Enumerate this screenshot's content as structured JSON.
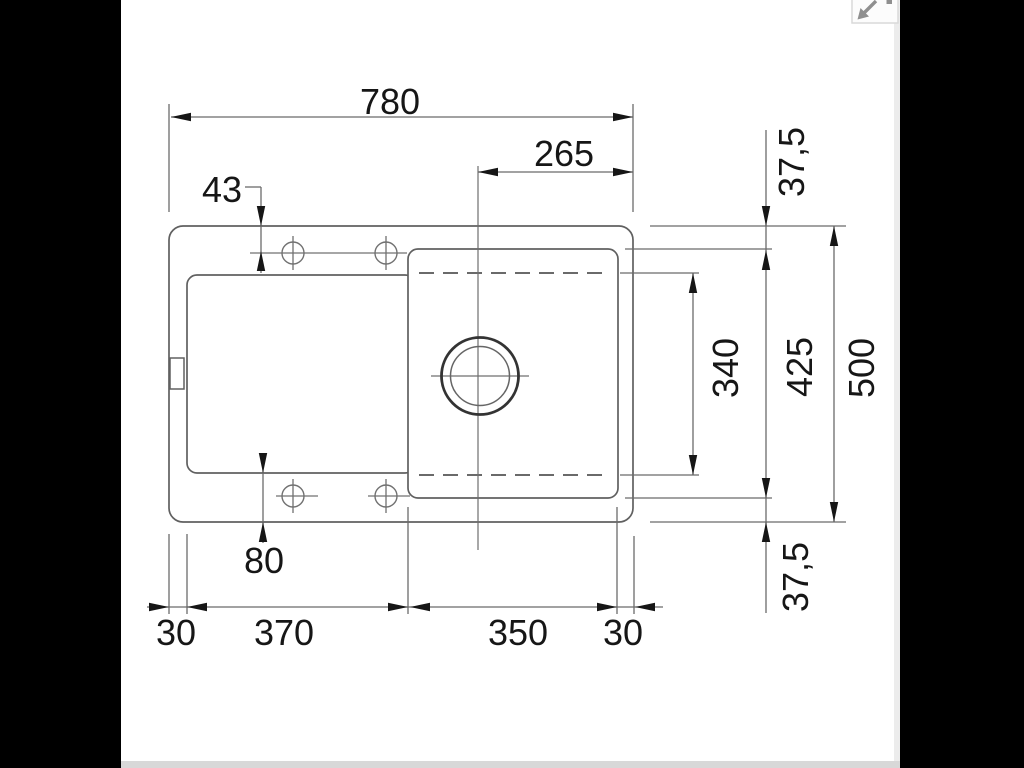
{
  "viewer": {
    "background_color": "#000000",
    "content_background_color": "#ffffff",
    "scrollbar_color": "#d8d8d8",
    "expand_icon": "resize-diagonal-arrows",
    "expand_icon_color": "#8f8f8f"
  },
  "drawing": {
    "subject": "sink-top-view-dimension-drawing",
    "line_color": "#606060",
    "dimension_line_color": "#6b6b6b",
    "text_color": "#161616",
    "dimensions": {
      "overall_width": "780",
      "drain_center_to_right_edge": "265",
      "tap_holes_from_top_edge": "43",
      "rim_top": "37,5",
      "bowl_inner_depth": "340",
      "bowl_depth": "425",
      "overall_depth": "500",
      "rim_bottom": "37,5",
      "drainboard_to_bottom_edge": "80",
      "rim_left": "30",
      "drainboard_width": "370",
      "bowl_width": "350",
      "rim_right": "30"
    }
  }
}
